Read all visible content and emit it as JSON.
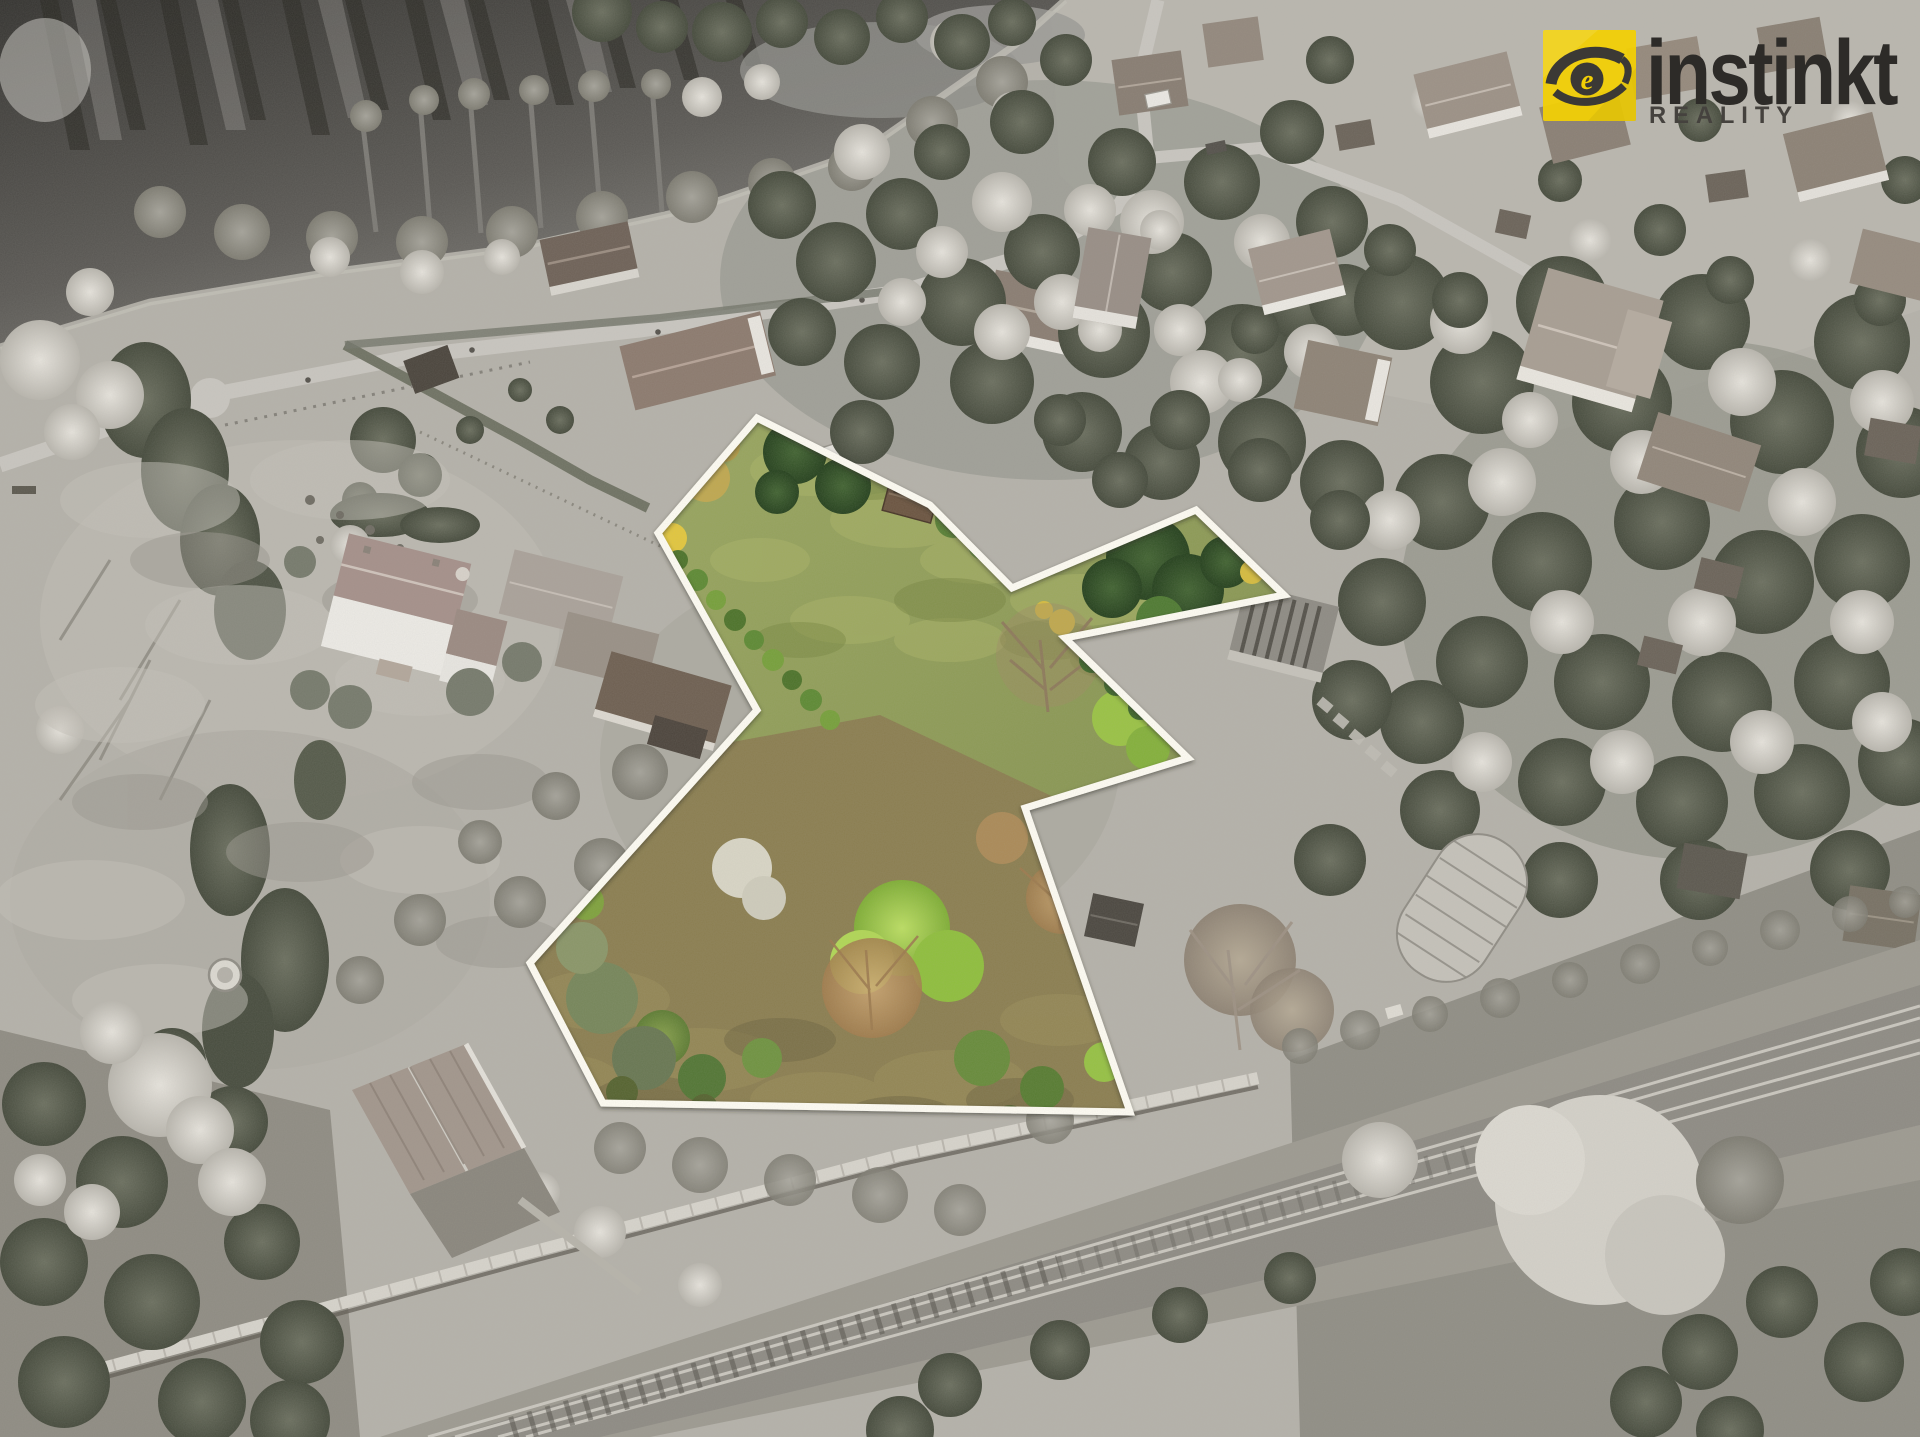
{
  "logo": {
    "brand": "instinkt",
    "subtitle": "REALITY",
    "icon": "eye-icon",
    "square_color": "#f2cf05",
    "brand_color": "#2d2b28",
    "subtitle_color": "#45423e"
  },
  "plot": {
    "name": "highlighted-parcel",
    "outline_color": "#fffdf4",
    "outline_points": "757,418 930,505 1012,588 1196,510 1284,595 1065,638 1188,758 1025,808 1130,1112 603,1103 530,963 757,710 658,533"
  },
  "scene": {
    "description": "Aerial drone photo: parcel for sale shown in colour inside a white boundary, surroundings desaturated; lake top-left, village top-right, forest at right, railway line across the bottom.",
    "regions": {
      "lake": "top-left",
      "village": "top-right",
      "forest": "centre and right",
      "meadow": "left",
      "railway": "bottom",
      "highlighted_parcel": "centre"
    }
  }
}
